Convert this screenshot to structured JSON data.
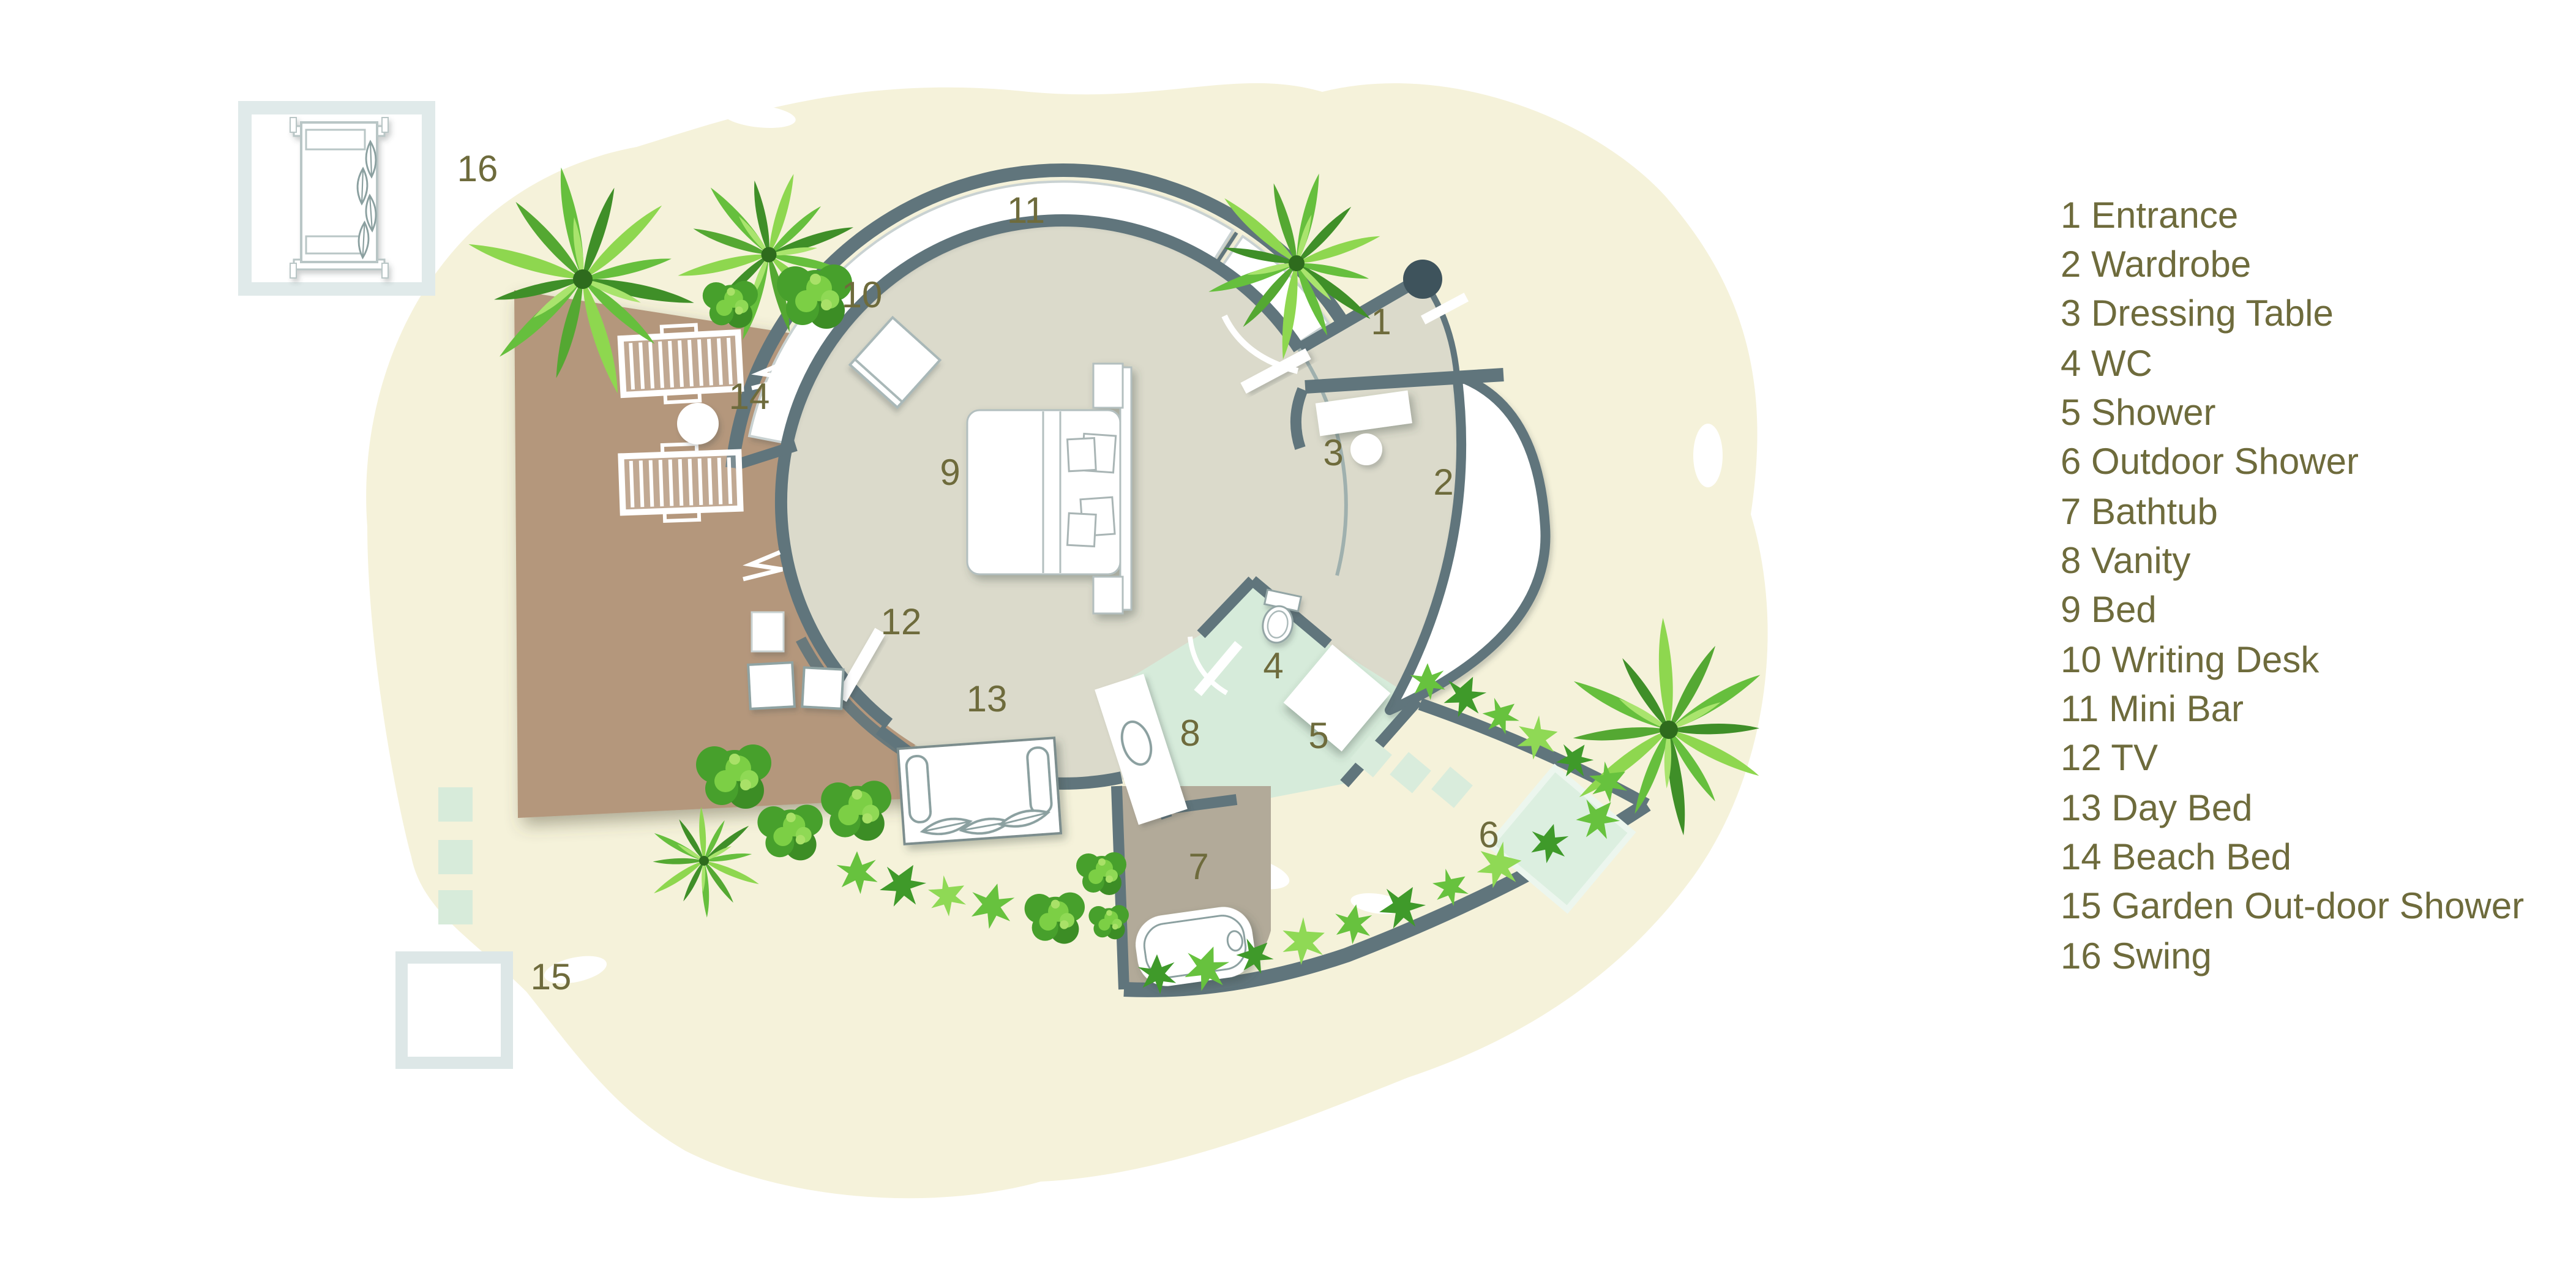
{
  "legend": {
    "items": [
      "1 Entrance",
      "2 Wardrobe",
      "3 Dressing Table",
      "4 WC",
      "5 Shower",
      "6 Outdoor Shower",
      "7 Bathtub",
      "8 Vanity",
      "9 Bed",
      "10 Writing Desk",
      "11 Mini Bar",
      "12 TV",
      "13 Day Bed",
      "14 Beach Bed",
      "15 Garden Out-door Shower",
      "16 Swing"
    ]
  },
  "plan": {
    "numbers": [
      "1",
      "2",
      "3",
      "4",
      "5",
      "6",
      "7",
      "8",
      "9",
      "10",
      "11",
      "12",
      "13",
      "14",
      "15",
      "16"
    ]
  },
  "colors": {
    "label_olive": "#6e6b3c",
    "wall_slate": "#60757c",
    "interior_floor": "#dbdacb",
    "deck_brown": "#b4977b",
    "bath_floor_taupe": "#b2aa99",
    "bathroom_mint": "#d6ebda",
    "garden_cream": "#f5f2da",
    "pivot_dark": "#3e535c",
    "swing_frame": "#e0eaea",
    "shower_frame": "#dce6e5",
    "palm_green": "#66bf3d",
    "furniture_white": "#ffffff"
  }
}
